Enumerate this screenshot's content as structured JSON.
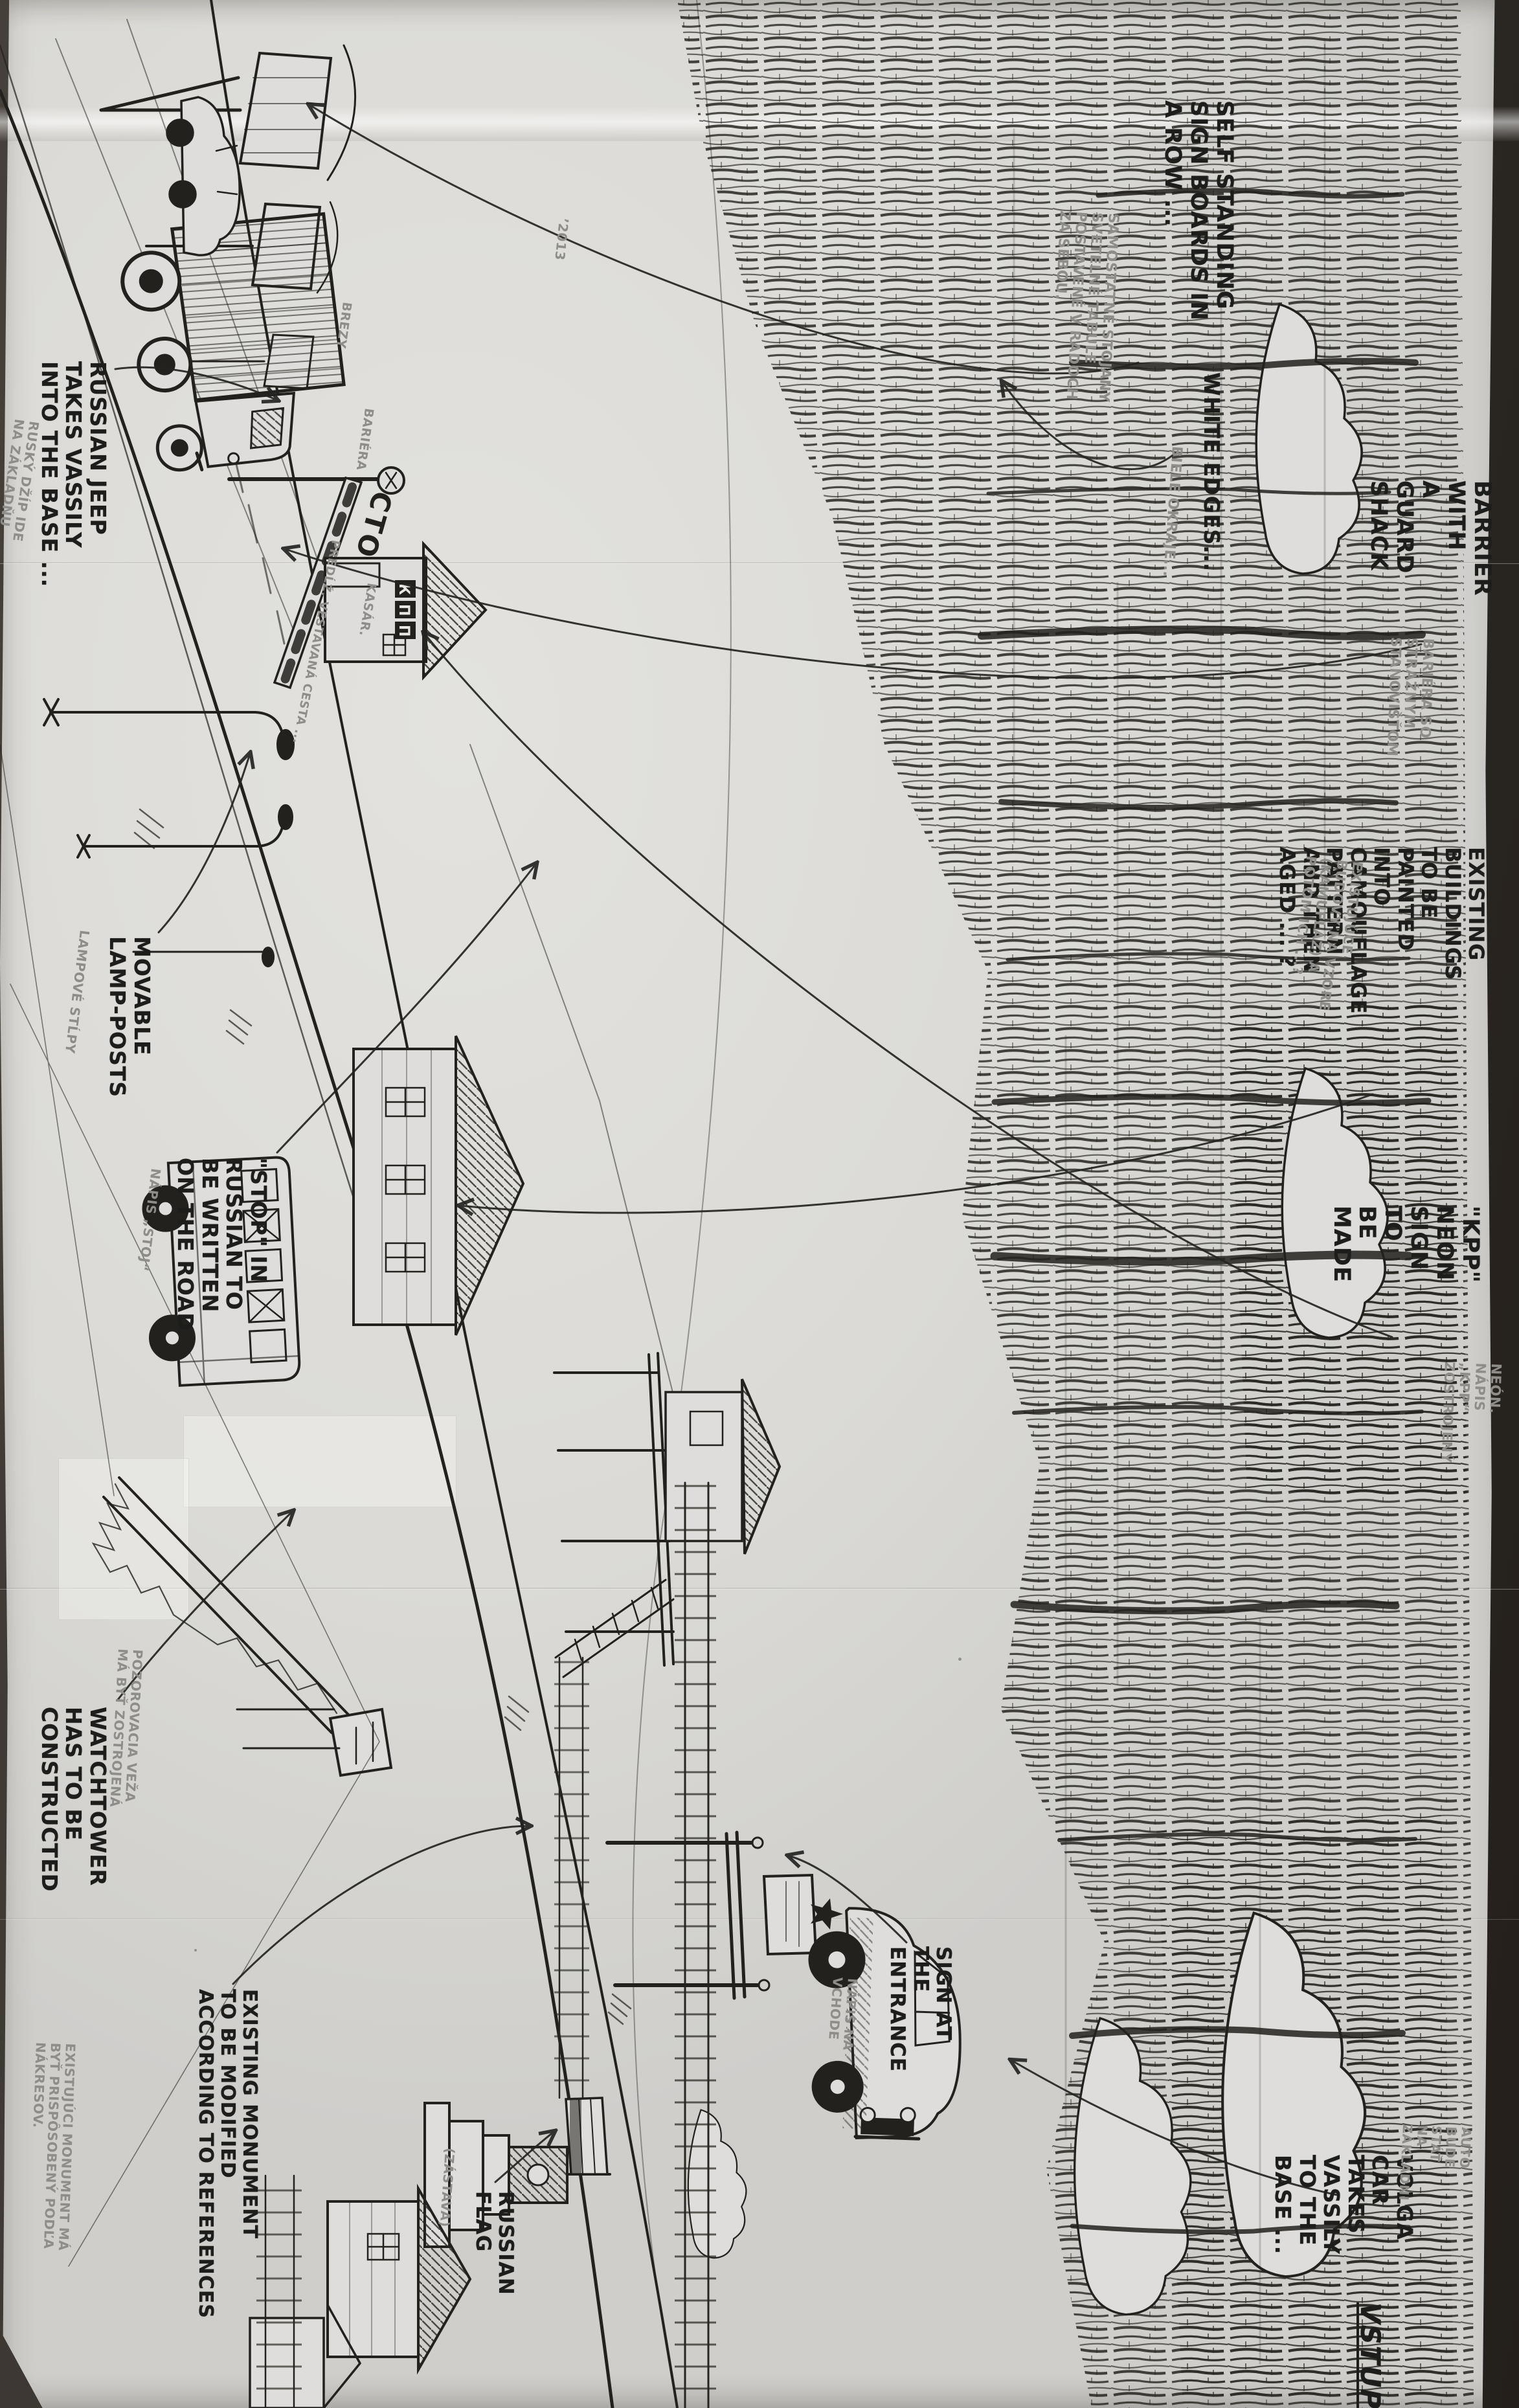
{
  "meta": {
    "description": "Hand-drawn production-design sketch of a Russian military checkpoint (KPP) with English ink annotations and Slovak pencil translations, photographed on folded paper",
    "ink_color": "#1d1d1b",
    "pencil_color": "#8e8d89",
    "paper_color": "#dedddb",
    "backdrop_color": "#35302a"
  },
  "notes": {
    "self_standing": "SELF STANDING\nSIGN BOARDS IN\nA ROW ...",
    "self_standing_sk": "SAMOSTATNÉ STOJANY\nSVETELNÉ TABULE\nPOSTAVENÉ V RADOCH\nZA SEBOU.",
    "white_edges": "WHITE EDGES...",
    "white_edges_sk": "BIELE OKRAJE...",
    "barrier": "BARRIER WITH\nA GUARD SHACK",
    "barrier_sk": "BARIÉRA SO STRÁŽNYM\nSTANOVIŠŤOM",
    "existing_buildings": "EXISTING BUILDINGS\nTO BE PAINTED INTO\nCAMOUFLAGE PATTERN\nAND THEN AGED ... ?",
    "existing_buildings_sk": "EXISTUJÚCE BUDOVY NA VZORE\n(KAMUFLÁŽ) A POTOM ICH ...?",
    "kpp_neon": "\"KPP\" NEON SIGN\nTO BE MADE",
    "kpp_neon_sk": "NEÓN.\nNÁPIS „KPP“\nZOSTROJENÝ",
    "russian_jeep": "RUSSIAN JEEP\nTAKES VASSILY\nINTO THE BASE ...",
    "russian_jeep_sk": "RUSKÝ DŽÍP IDE\nNA ZÁKLADŇU",
    "movable_lamps": "MOVABLE\nLAMP-POSTS",
    "movable_lamps_sk": "LAMPOVÉ STĹPY",
    "stop_road": "\"STOP\" IN\nRUSSIAN TO\nBE WRITTEN\nON THE ROAD",
    "stop_road_sk": "NÁPIS „STOJ“",
    "watchtower": "WATCHTOWER\nHAS TO BE\nCONSTRUCTED",
    "watchtower_sk": "POZOROVACIA VEŽA\nMÁ BYŤ ZOSTROJENÁ",
    "monument": "EXISTING MONUMENT\nTO BE MODIFIED\nACCORDING TO REFERENCES",
    "monument_sk": "EXISTUJÚCI MONUMENT MÁ\nBYŤ PRISPÔSOBENÝ PODĽA\nNÁKRESOV.",
    "entrance_sign": "SIGN AT\nTHE\nENTRANCE",
    "entrance_sign_sk": "NÁPIS NA\nVCHODE",
    "volga": "VOLGA CAR TAKES\nVASSILY TO THE\nBASE ...",
    "volga_sk": "AUTO BUDE STÁŤ\nNA ZÁKLADNI",
    "vstup": "VSTUP",
    "russian_flag": "RUSSIAN\nFLAG",
    "russian_flag_sk": "(ZÁSTAVA)",
    "brezy": "BREZY",
    "bariera_small": "BARIÉRA",
    "year_note": "’2013",
    "kasar": "KASÁR.",
    "cesta": "PREDĹŽ. VESTAVANÁ CESTA ..."
  },
  "artwork_text": {
    "gate_sign": "СТОП",
    "kpp_letters": [
      "К",
      "П",
      "П"
    ]
  }
}
